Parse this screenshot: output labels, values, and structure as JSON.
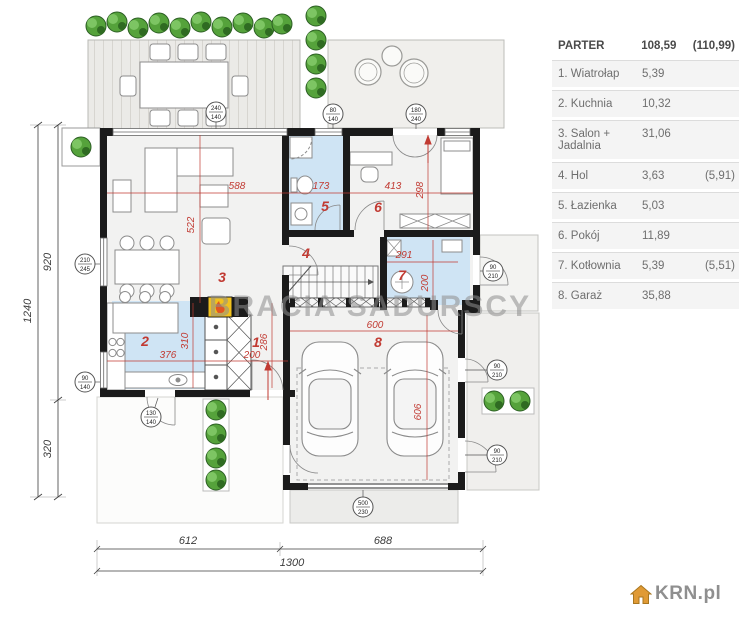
{
  "legend": {
    "header": {
      "label": "PARTER",
      "area": "108,59",
      "extra": "(110,99)"
    },
    "rows": [
      {
        "label": "1. Wiatrołap",
        "area": "5,39",
        "extra": ""
      },
      {
        "label": "2. Kuchnia",
        "area": "10,32",
        "extra": ""
      },
      {
        "label": "3. Salon + Jadalnia",
        "area": "31,06",
        "extra": ""
      },
      {
        "label": "4. Hol",
        "area": "3,63",
        "extra": "(5,91)"
      },
      {
        "label": "5. Łazienka",
        "area": "5,03",
        "extra": ""
      },
      {
        "label": "6. Pokój",
        "area": "11,89",
        "extra": ""
      },
      {
        "label": "7. Kotłownia",
        "area": "5,39",
        "extra": "(5,51)"
      },
      {
        "label": "8. Garaż",
        "area": "35,88",
        "extra": ""
      }
    ]
  },
  "watermark": "BRACIA SADURSCY",
  "brand": {
    "name": "KRN.pl",
    "icon": "house-icon"
  },
  "colors": {
    "accent_red": "#c13a32",
    "room_blue": "#cfe4f4",
    "wall_black": "#1b1b1b",
    "fireplace_yellow": "#f2c21d",
    "greenery": "#55a23b",
    "watermark_gray": "#8e8e8e",
    "logo_orange": "#e09a35"
  },
  "plan": {
    "rooms": [
      {
        "num": "1",
        "name": "wiatrolap"
      },
      {
        "num": "2",
        "name": "kuchnia"
      },
      {
        "num": "3",
        "name": "salon-jadalnia"
      },
      {
        "num": "4",
        "name": "hol"
      },
      {
        "num": "5",
        "name": "lazienka"
      },
      {
        "num": "6",
        "name": "pokoj"
      },
      {
        "num": "7",
        "name": "kotlownia"
      },
      {
        "num": "8",
        "name": "garaz"
      }
    ],
    "dims": {
      "salon_w": "588",
      "salon_h": "522",
      "bath_w": "173",
      "room6_w": "413",
      "room6_h": "298",
      "boiler_w": "291",
      "boiler_h": "200",
      "kitchen_w": "376",
      "kitchen_h": "310",
      "hall_w": "200",
      "hall_h": "286",
      "garage_w": "600",
      "garage_h": "606"
    },
    "outer_dims": {
      "v_total": "1240",
      "v_upper": "920",
      "v_lower": "320",
      "h_left": "612",
      "h_right": "688",
      "h_total": "1300"
    },
    "markers": [
      {
        "top": "240",
        "bot": "140"
      },
      {
        "top": "80",
        "bot": "140"
      },
      {
        "top": "180",
        "bot": "240"
      },
      {
        "top": "210",
        "bot": "245"
      },
      {
        "top": "90",
        "bot": "140"
      },
      {
        "top": "130",
        "bot": "140"
      },
      {
        "top": "90",
        "bot": "210"
      },
      {
        "top": "90",
        "bot": "210"
      },
      {
        "top": "90",
        "bot": "210"
      },
      {
        "top": "500",
        "bot": "230"
      }
    ]
  }
}
